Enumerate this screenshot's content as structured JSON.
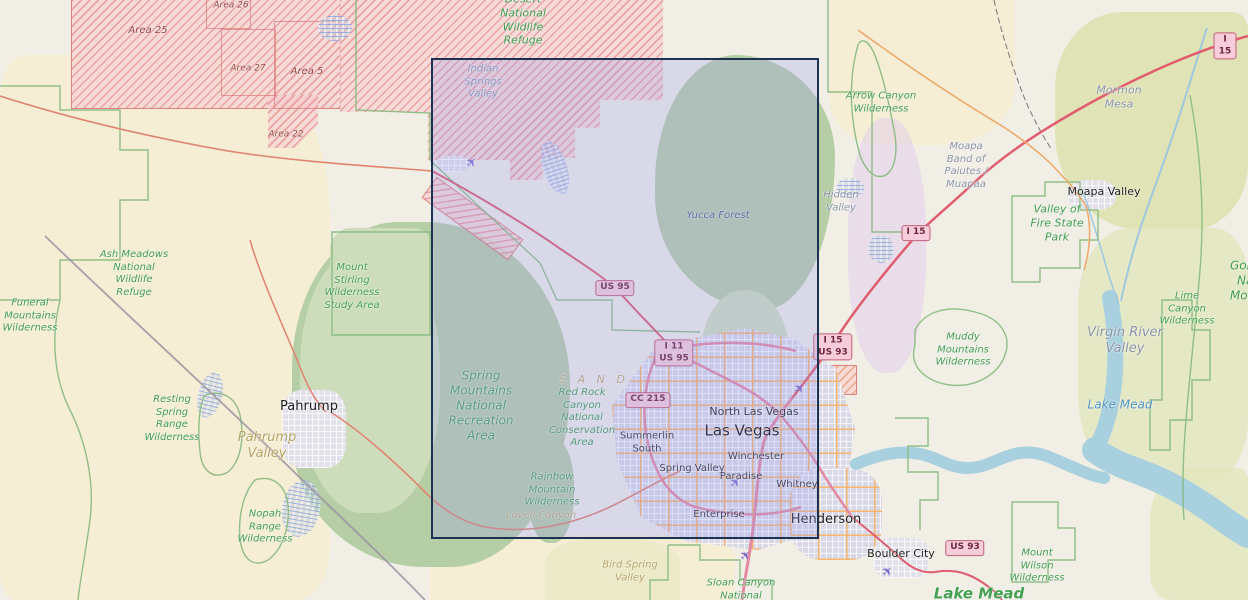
{
  "map": {
    "title": "OpenStreetMap view of the Las Vegas, Nevada region with a rectangular map selection",
    "selection": {
      "x": 431,
      "y": 58,
      "width": 388,
      "height": 481
    },
    "colors": {
      "selection_border": "#1b3350",
      "selection_fill": "rgba(150,156,238,0.26)",
      "park_label_green": "#3e9c4d",
      "restricted_hatch_red": "#db7575",
      "motorway_red": "#e05c6e",
      "water_blue": "#a8d0de",
      "shield_pink": "#f6cdd8",
      "airport_purple": "#7a63c9"
    },
    "icons": {
      "airport": "✈"
    },
    "labels": [
      {
        "text": "Desert\nNational\nWildlife\nRefuge",
        "x": 523,
        "y": 20,
        "type": "park park-md"
      },
      {
        "text": "Ash Meadows\nNational\nWildlife\nRefuge",
        "x": 134,
        "y": 274,
        "type": "park"
      },
      {
        "text": "Funeral\nMountains\nWilderness",
        "x": 30,
        "y": 316,
        "type": "park"
      },
      {
        "text": "Mount\nStirling\nWilderness\nStudy Area",
        "x": 352,
        "y": 287,
        "type": "park"
      },
      {
        "text": "Resting\nSpring\nRange\nWilderness",
        "x": 172,
        "y": 419,
        "type": "park"
      },
      {
        "text": "Nopah\nRange\nWilderness",
        "x": 265,
        "y": 527,
        "type": "park"
      },
      {
        "text": "Spring\nMountains\nNational\nRecreation\nArea",
        "x": 481,
        "y": 406,
        "type": "park park-lg"
      },
      {
        "text": "Red Rock\nCanyon\nNational\nConservation\nArea",
        "x": 582,
        "y": 418,
        "type": "park"
      },
      {
        "text": "Rainbow\nMountain\nWilderness",
        "x": 552,
        "y": 490,
        "type": "park"
      },
      {
        "text": "Arrow Canyon\nWilderness",
        "x": 881,
        "y": 103,
        "type": "park"
      },
      {
        "text": "Valley of\nFire State\nPark",
        "x": 1057,
        "y": 223,
        "type": "park park-md"
      },
      {
        "text": "Muddy\nMountains\nWilderness",
        "x": 963,
        "y": 350,
        "type": "park"
      },
      {
        "text": "Lime Canyon\nWilderness",
        "x": 1187,
        "y": 309,
        "type": "park"
      },
      {
        "text": "Gold Butte\nNational\nMonument",
        "x": 1262,
        "y": 281,
        "type": "park park-lg"
      },
      {
        "text": "Mount\nWilson\nWilderness",
        "x": 1037,
        "y": 566,
        "type": "park"
      },
      {
        "text": "Sloan Canyon\nNational\nConservation",
        "x": 741,
        "y": 596,
        "type": "park"
      },
      {
        "text": "Lake Mead",
        "x": 979,
        "y": 594,
        "type": "park park-xl"
      },
      {
        "text": "Indian\nSprings\nValley",
        "x": 483,
        "y": 82,
        "type": "valley"
      },
      {
        "text": "Mormon\nMesa",
        "x": 1119,
        "y": 97,
        "type": "valley valley-md"
      },
      {
        "text": "Moapa\nBand of\nPaiutes /\nMuapaa",
        "x": 966,
        "y": 166,
        "type": "valley"
      },
      {
        "text": "Hidden\nValley",
        "x": 841,
        "y": 202,
        "type": "valley"
      },
      {
        "text": "Virgin River\nValley",
        "x": 1125,
        "y": 341,
        "type": "valley valley-lg"
      },
      {
        "text": "Yucca Forest",
        "x": 718,
        "y": 216,
        "type": "valley valley-dark"
      },
      {
        "text": "Pahrump\nValley",
        "x": 267,
        "y": 446,
        "type": "tanlbl tan-lg"
      },
      {
        "text": "Lovell Canyon",
        "x": 541,
        "y": 516,
        "type": "tanlbl"
      },
      {
        "text": "Bird Spring\nValley",
        "x": 630,
        "y": 572,
        "type": "tanlbl"
      },
      {
        "text": "S A N D",
        "x": 594,
        "y": 380,
        "type": "sand"
      },
      {
        "text": "Lake Mead",
        "x": 1120,
        "y": 405,
        "type": "water-lbl"
      },
      {
        "text": "Pahrump",
        "x": 309,
        "y": 407,
        "type": "town town-md"
      },
      {
        "text": "Moapa Valley",
        "x": 1104,
        "y": 192,
        "type": "town"
      },
      {
        "text": "North Las Vegas",
        "x": 754,
        "y": 412,
        "type": "town"
      },
      {
        "text": "Las Vegas",
        "x": 742,
        "y": 431,
        "type": "town town-lg"
      },
      {
        "text": "Winchester",
        "x": 756,
        "y": 457,
        "type": "town town-sm"
      },
      {
        "text": "Spring Valley",
        "x": 692,
        "y": 469,
        "type": "town town-sm"
      },
      {
        "text": "Paradise",
        "x": 741,
        "y": 477,
        "type": "town town-sm"
      },
      {
        "text": "Whitney",
        "x": 797,
        "y": 485,
        "type": "town town-sm"
      },
      {
        "text": "Enterprise",
        "x": 719,
        "y": 515,
        "type": "town town-sm"
      },
      {
        "text": "Henderson",
        "x": 826,
        "y": 520,
        "type": "town town-md"
      },
      {
        "text": "Summerlin\nSouth",
        "x": 647,
        "y": 443,
        "type": "town town-sm"
      },
      {
        "text": "Boulder City",
        "x": 901,
        "y": 554,
        "type": "town"
      },
      {
        "text": "Area 25",
        "x": 148,
        "y": 31,
        "type": "arealbl"
      },
      {
        "text": "Area 26",
        "x": 231,
        "y": 6,
        "type": "arealbl area-sm"
      },
      {
        "text": "Area 27",
        "x": 248,
        "y": 69,
        "type": "arealbl area-sm"
      },
      {
        "text": "Area 5",
        "x": 307,
        "y": 72,
        "type": "arealbl"
      },
      {
        "text": "Area 22",
        "x": 286,
        "y": 135,
        "type": "arealbl area-sm"
      }
    ],
    "shields": [
      {
        "lines": [
          "I 15"
        ],
        "x": 1225,
        "y": 46
      },
      {
        "lines": [
          "I 15"
        ],
        "x": 916,
        "y": 233
      },
      {
        "lines": [
          "I 15",
          "US 93"
        ],
        "x": 833,
        "y": 347
      },
      {
        "lines": [
          "US 95"
        ],
        "x": 615,
        "y": 288
      },
      {
        "lines": [
          "I 11",
          "US 95"
        ],
        "x": 674,
        "y": 353
      },
      {
        "lines": [
          "CC 215"
        ],
        "x": 648,
        "y": 400
      },
      {
        "lines": [
          "US 93"
        ],
        "x": 965,
        "y": 548
      }
    ],
    "airports": [
      {
        "x": 472,
        "y": 163
      },
      {
        "x": 800,
        "y": 389
      },
      {
        "x": 736,
        "y": 483
      },
      {
        "x": 746,
        "y": 556
      },
      {
        "x": 888,
        "y": 572
      }
    ]
  }
}
